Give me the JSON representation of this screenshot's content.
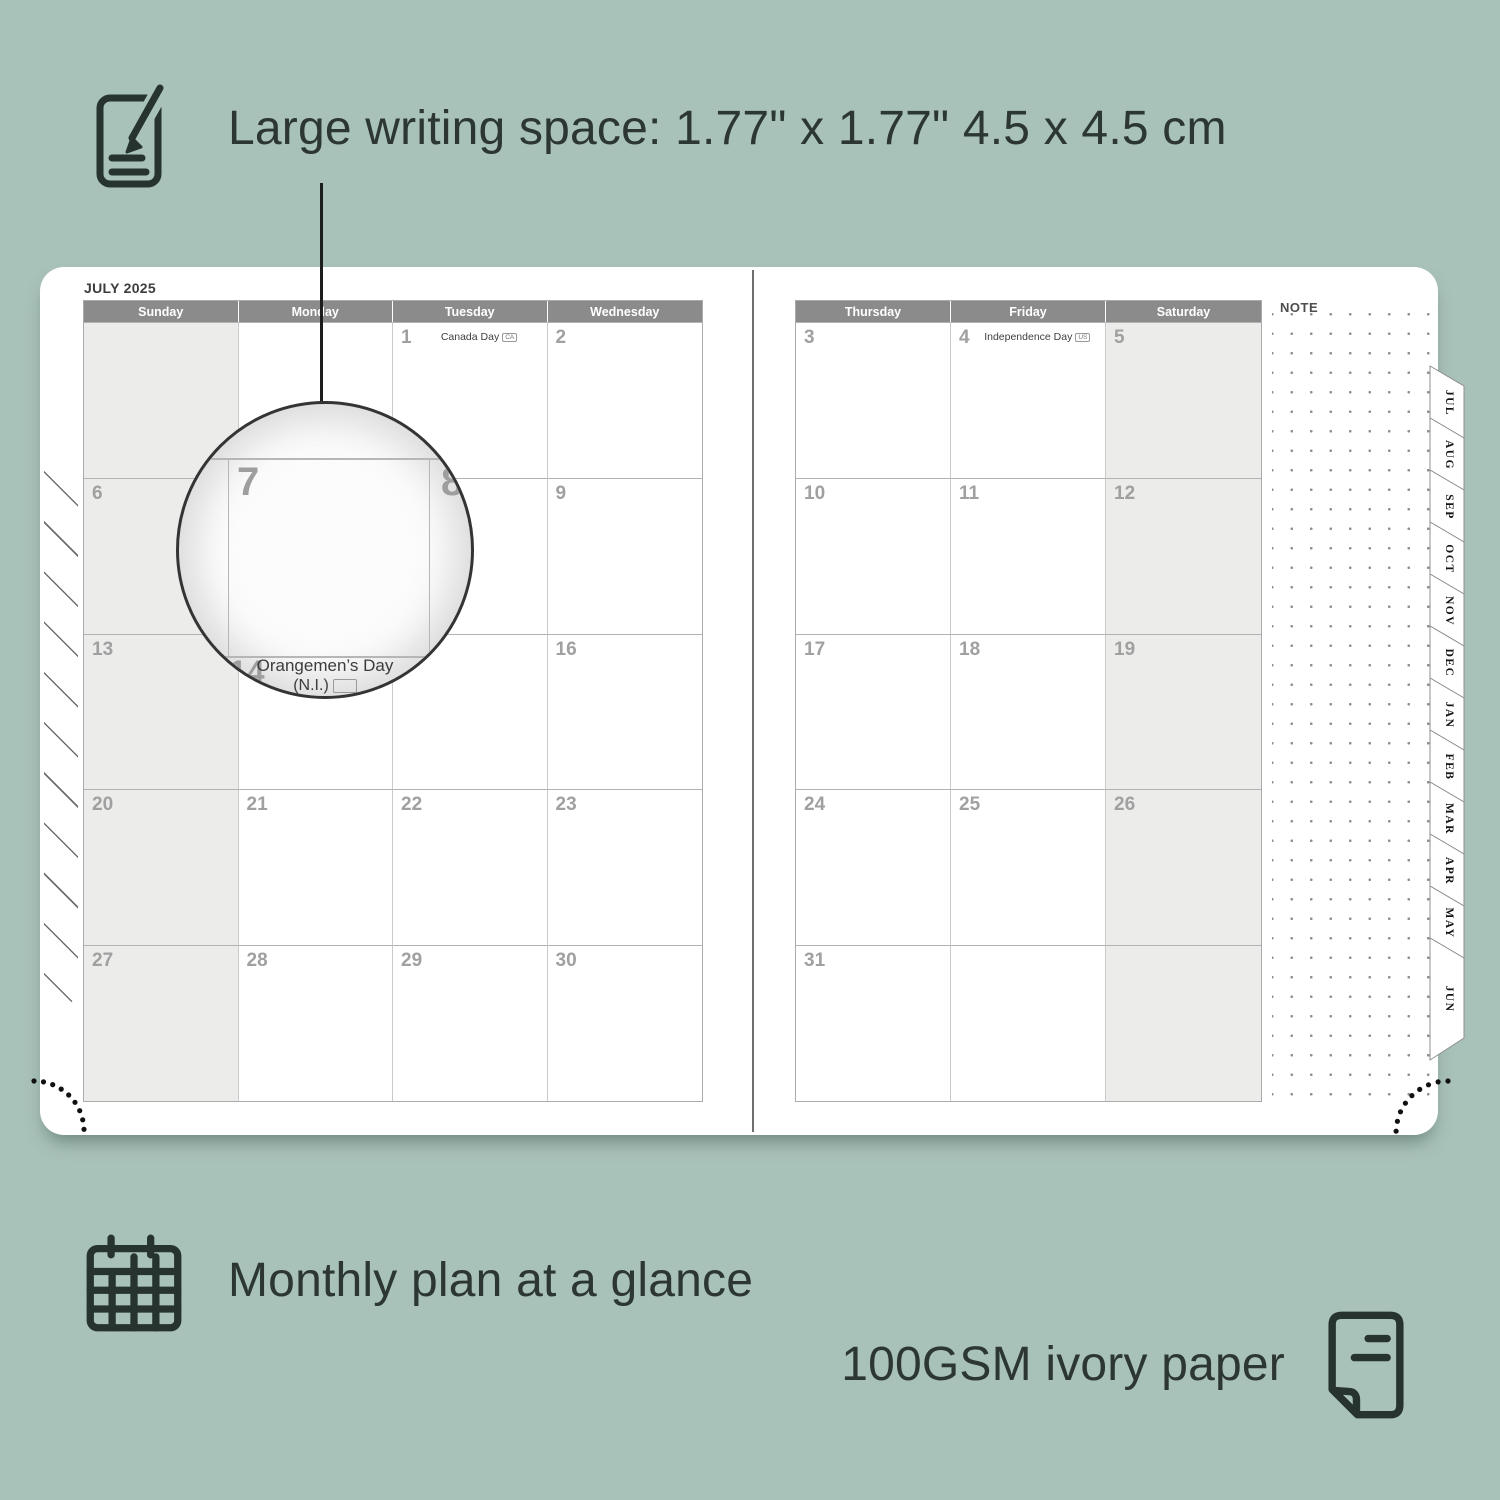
{
  "colors": {
    "background": "#a9c2b9",
    "ink": "#2c3733",
    "page": "#ffffff",
    "header_bar": "#8b8b8b",
    "header_text": "#ffffff",
    "shaded_column": "#ececeb",
    "date_number": "#a0a0a0",
    "grid_line": "#b2b2b2",
    "note_dot": "#8f8f8f"
  },
  "features": [
    {
      "id": "writing-space",
      "icon": "notepad-pencil-icon",
      "text": "Large writing space: 1.77\" x 1.77\" 4.5 x 4.5 cm"
    },
    {
      "id": "monthly-plan",
      "icon": "calendar-grid-icon",
      "text": "Monthly plan at a glance"
    },
    {
      "id": "paper",
      "icon": "paper-sheet-icon",
      "text": "100GSM ivory paper"
    }
  ],
  "planner": {
    "month_title": "JULY 2025",
    "note_label": "NOTE",
    "tabs": [
      "JUL",
      "AUG",
      "SEP",
      "OCT",
      "NOV",
      "DEC",
      "JAN",
      "FEB",
      "MAR",
      "APR",
      "MAY",
      "JUN"
    ],
    "left_page": {
      "day_headers": [
        "Sunday",
        "Monday",
        "Tuesday",
        "Wednesday"
      ],
      "shaded_column": 0,
      "rows": [
        [
          {
            "d": ""
          },
          {
            "d": ""
          },
          {
            "d": "1",
            "event": "Canada Day",
            "badge": "CA"
          },
          {
            "d": "2"
          }
        ],
        [
          {
            "d": "6"
          },
          {
            "d": "7",
            "covered": true
          },
          {
            "d": "8",
            "covered": true
          },
          {
            "d": "9"
          }
        ],
        [
          {
            "d": "13"
          },
          {
            "d": "14",
            "covered": true
          },
          {
            "d": "15"
          },
          {
            "d": "16"
          }
        ],
        [
          {
            "d": "20"
          },
          {
            "d": "21"
          },
          {
            "d": "22"
          },
          {
            "d": "23"
          }
        ],
        [
          {
            "d": "27"
          },
          {
            "d": "28"
          },
          {
            "d": "29"
          },
          {
            "d": "30"
          }
        ]
      ]
    },
    "right_page": {
      "day_headers": [
        "Thursday",
        "Friday",
        "Saturday"
      ],
      "shaded_column": 2,
      "rows": [
        [
          {
            "d": "3"
          },
          {
            "d": "4",
            "event": "Independence Day",
            "badge": "US"
          },
          {
            "d": "5"
          }
        ],
        [
          {
            "d": "10"
          },
          {
            "d": "11"
          },
          {
            "d": "12"
          }
        ],
        [
          {
            "d": "17"
          },
          {
            "d": "18"
          },
          {
            "d": "19"
          }
        ],
        [
          {
            "d": "24"
          },
          {
            "d": "25"
          },
          {
            "d": "26"
          }
        ],
        [
          {
            "d": "31"
          },
          {
            "d": ""
          },
          {
            "d": ""
          }
        ]
      ]
    },
    "magnifier": {
      "day": "7",
      "next_day": "8",
      "hidden_day": "14",
      "event_line1": "Orangemen’s Day",
      "event_line2": "(N.I.)"
    }
  }
}
